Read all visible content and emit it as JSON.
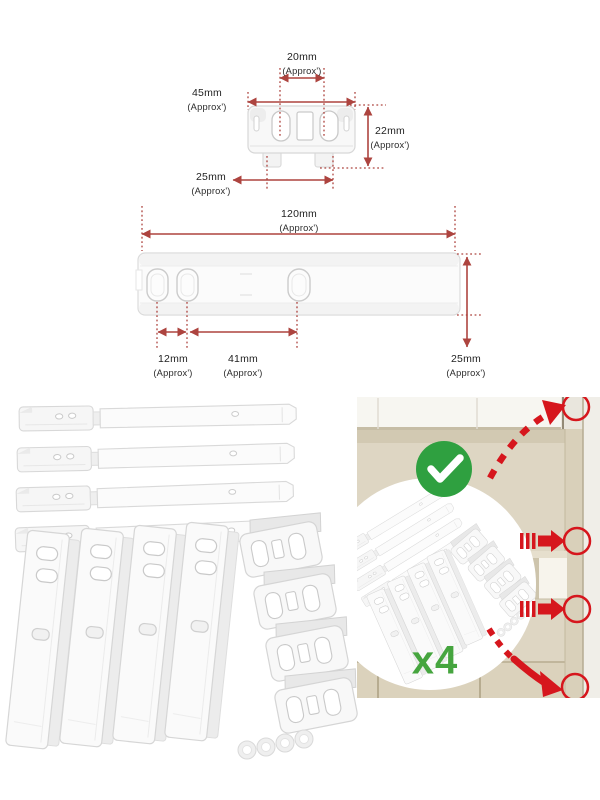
{
  "image": {
    "description": "Integrated appliance door slider mounting kit – dimension diagrams, kit contents and fitting illustration",
    "approx_note": "(Approx')"
  },
  "clip_diagram": {
    "slot_spacing": {
      "value": "20mm",
      "approx": "(Approx')"
    },
    "width": {
      "value": "45mm",
      "approx": "(Approx')"
    },
    "height": {
      "value": "22mm",
      "approx": "(Approx')"
    },
    "tab_spacing": {
      "value": "25mm",
      "approx": "(Approx')"
    }
  },
  "rail_diagram": {
    "length": {
      "value": "120mm",
      "approx": "(Approx')"
    },
    "peg_gap_small": {
      "value": "12mm",
      "approx": "(Approx')"
    },
    "peg_gap_large": {
      "value": "41mm",
      "approx": "(Approx')"
    },
    "height": {
      "value": "25mm",
      "approx": "(Approx')"
    }
  },
  "install_panel": {
    "quantity_label": "x4"
  },
  "colors": {
    "dimension_red": "#ad443f",
    "signal_red": "#d6161d",
    "check_green": "#2fa040",
    "quantity_green": "#46a53f",
    "wall_beige": "#ded6c3"
  }
}
